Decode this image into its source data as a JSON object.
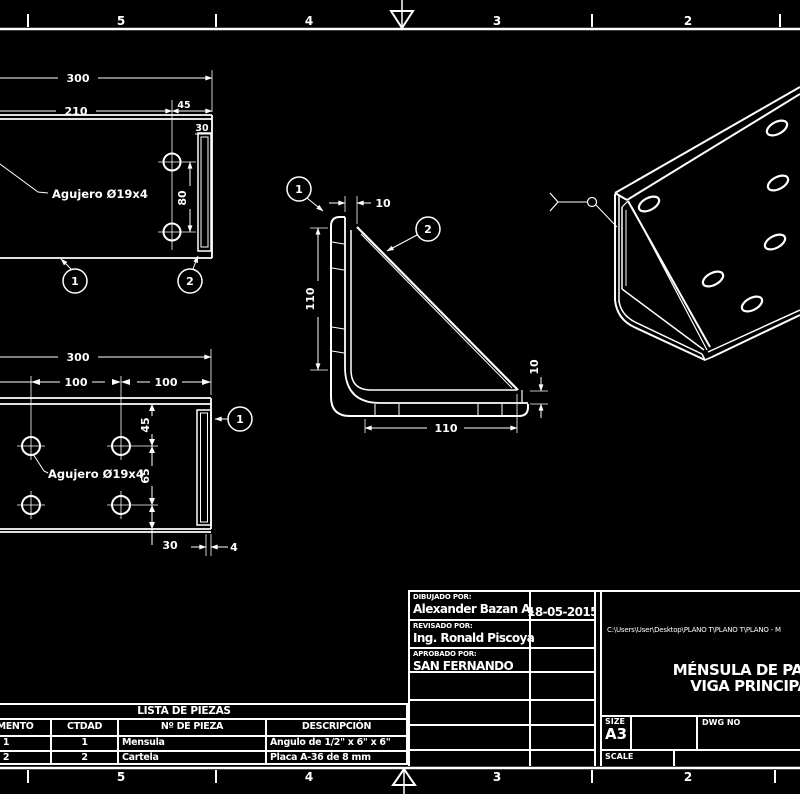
{
  "colors": {
    "background": "#000000",
    "line": "#ffffff"
  },
  "border": {
    "top_zones": [
      "5",
      "4",
      "3",
      "2"
    ],
    "bottom_zones": [
      "5",
      "4",
      "3",
      "2"
    ]
  },
  "top_view": {
    "d300": "300",
    "d210": "210",
    "d45": "45",
    "d30": "30",
    "d80": "80",
    "hole_note": "Agujero Ø19x4",
    "balloon1": "1",
    "balloon2": "2"
  },
  "front_view": {
    "d10_top": "10",
    "d110_left": "110",
    "d110_bottom": "110",
    "d10_right": "10",
    "balloon1": "1",
    "balloon2": "2"
  },
  "bottom_view": {
    "d300": "300",
    "d100_left": "100",
    "d100_right": "100",
    "d45": "45",
    "d65": "65",
    "d30": "30",
    "d4": "4",
    "hole_note": "Agujero Ø19x4",
    "balloon1": "1"
  },
  "title_block": {
    "drawn_by_label": "DIBUJADO POR:",
    "drawn_by": "Alexander Bazan A.",
    "date": "18-05-2015",
    "reviewed_by_label": "REVISADO POR:",
    "reviewed_by": "Ing. Ronald Piscoya",
    "approved_by_label": "APROBADO POR:",
    "approved_by": "SAN FERNANDO",
    "file_path": "C:\\Users\\User\\Desktop\\PLANO T\\PLANO T\\PLANO - M",
    "title_line1": "MÉNSULA DE PARED",
    "title_line2": "VIGA PRINCIPAL",
    "size_label": "SIZE",
    "size": "A3",
    "dwg_no_label": "DWG NO",
    "scale_label": "SCALE"
  },
  "parts_list": {
    "title": "LISTA DE PIEZAS",
    "columns": [
      "ELEMENTO",
      "CTDAD",
      "Nº DE PIEZA",
      "DESCRIPCIÓN"
    ],
    "rows": [
      {
        "item": "1",
        "qty": "1",
        "part": "Mensula",
        "desc": "Ángulo de 1/2\" x 6\" x 6\""
      },
      {
        "item": "2",
        "qty": "2",
        "part": "Cartela",
        "desc": "Placa A-36 de 8 mm"
      }
    ]
  }
}
